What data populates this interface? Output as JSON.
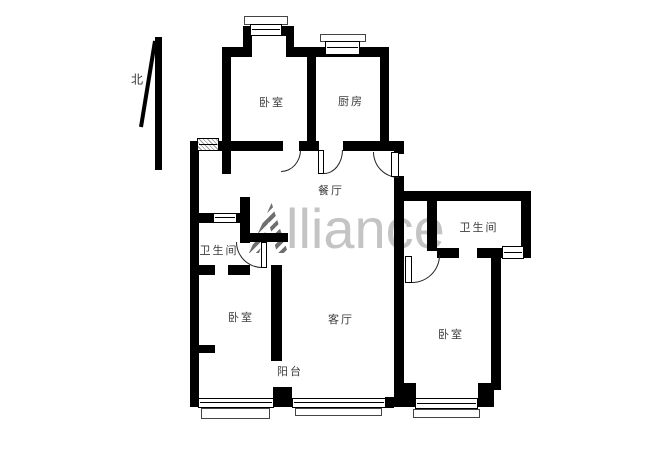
{
  "meta": {
    "type": "apartment-floor-plan"
  },
  "north": {
    "label": "北",
    "x": 137,
    "y": 79
  },
  "watermark": {
    "logo_letter": "A",
    "text_after_logo": "lliance",
    "text_color": "#c4c4c4",
    "logo_color": "#6f6f6f"
  },
  "rooms": [
    {
      "id": "bedroom-top-left",
      "label": "卧室",
      "x": 272,
      "y": 102
    },
    {
      "id": "kitchen",
      "label": "厨房",
      "x": 351,
      "y": 101
    },
    {
      "id": "dining-room",
      "label": "餐厅",
      "x": 331,
      "y": 190
    },
    {
      "id": "bathroom-right",
      "label": "卫生间",
      "x": 479,
      "y": 227
    },
    {
      "id": "bathroom-left",
      "label": "卫生间",
      "x": 219,
      "y": 250
    },
    {
      "id": "bedroom-bottom-left",
      "label": "卧室",
      "x": 241,
      "y": 317
    },
    {
      "id": "living-room",
      "label": "客厅",
      "x": 341,
      "y": 319
    },
    {
      "id": "bedroom-bottom-right",
      "label": "卧室",
      "x": 451,
      "y": 334
    },
    {
      "id": "balcony",
      "label": "阳台",
      "x": 290,
      "y": 371
    }
  ],
  "walls": [
    [
      190,
      142,
      9,
      265
    ],
    [
      190,
      141,
      34,
      10
    ],
    [
      222,
      47,
      9,
      127
    ],
    [
      222,
      47,
      25,
      10
    ],
    [
      243,
      26,
      9,
      31
    ],
    [
      243,
      26,
      51,
      10
    ],
    [
      286,
      26,
      8,
      31
    ],
    [
      293,
      47,
      96,
      10
    ],
    [
      307,
      47,
      9,
      104
    ],
    [
      380,
      47,
      9,
      104
    ],
    [
      222,
      141,
      61,
      10
    ],
    [
      299,
      141,
      20,
      10
    ],
    [
      343,
      141,
      61,
      10
    ],
    [
      394,
      141,
      10,
      13
    ],
    [
      394,
      176,
      10,
      80
    ],
    [
      394,
      191,
      137,
      10
    ],
    [
      427,
      191,
      10,
      60
    ],
    [
      521,
      191,
      10,
      67
    ],
    [
      437,
      248,
      22,
      10
    ],
    [
      477,
      248,
      54,
      10
    ],
    [
      394,
      250,
      10,
      157
    ],
    [
      491,
      257,
      10,
      133
    ],
    [
      403,
      383,
      13,
      24
    ],
    [
      478,
      383,
      16,
      24
    ],
    [
      190,
      213,
      60,
      10
    ],
    [
      240,
      197,
      10,
      46
    ],
    [
      242,
      233,
      46,
      9
    ],
    [
      190,
      265,
      25,
      10
    ],
    [
      228,
      265,
      22,
      10
    ],
    [
      271,
      265,
      11,
      96
    ],
    [
      190,
      345,
      25,
      8
    ],
    [
      273,
      387,
      19,
      20
    ],
    [
      385,
      397,
      9,
      11
    ]
  ],
  "windows": [
    {
      "rect": [
        250,
        24,
        32,
        12
      ],
      "hatch": false
    },
    {
      "rect": [
        325,
        41,
        35,
        14
      ],
      "hatch": false
    },
    {
      "rect": [
        197,
        138,
        22,
        13
      ],
      "hatch": true
    },
    {
      "rect": [
        213,
        213,
        24,
        10
      ],
      "hatch": false
    },
    {
      "rect": [
        502,
        246,
        22,
        13
      ],
      "hatch": false
    },
    {
      "rect": [
        198,
        398,
        76,
        10
      ],
      "hatch": false
    },
    {
      "rect": [
        292,
        398,
        94,
        10
      ],
      "hatch": false
    },
    {
      "rect": [
        415,
        398,
        63,
        11
      ],
      "hatch": false
    }
  ],
  "railings": [
    [
      244,
      16,
      44,
      9
    ],
    [
      320,
      34,
      46,
      8
    ],
    [
      201,
      408,
      69,
      11
    ],
    [
      295,
      408,
      87,
      8
    ],
    [
      413,
      409,
      67,
      9
    ]
  ],
  "door_arcs": [
    {
      "rect": [
        281,
        150,
        20,
        22
      ],
      "corner": "br"
    },
    {
      "rect": [
        324,
        150,
        19,
        24
      ],
      "corner": "br"
    },
    {
      "rect": [
        373,
        152,
        26,
        26
      ],
      "corner": "bl"
    },
    {
      "rect": [
        236,
        242,
        26,
        26
      ],
      "corner": "bl"
    },
    {
      "rect": [
        412,
        255,
        28,
        28
      ],
      "corner": "br"
    }
  ],
  "door_leaves": [
    [
      318,
      150,
      6,
      24
    ],
    [
      391,
      152,
      8,
      25
    ],
    [
      261,
      242,
      6,
      26
    ],
    [
      405,
      256,
      7,
      27
    ]
  ]
}
